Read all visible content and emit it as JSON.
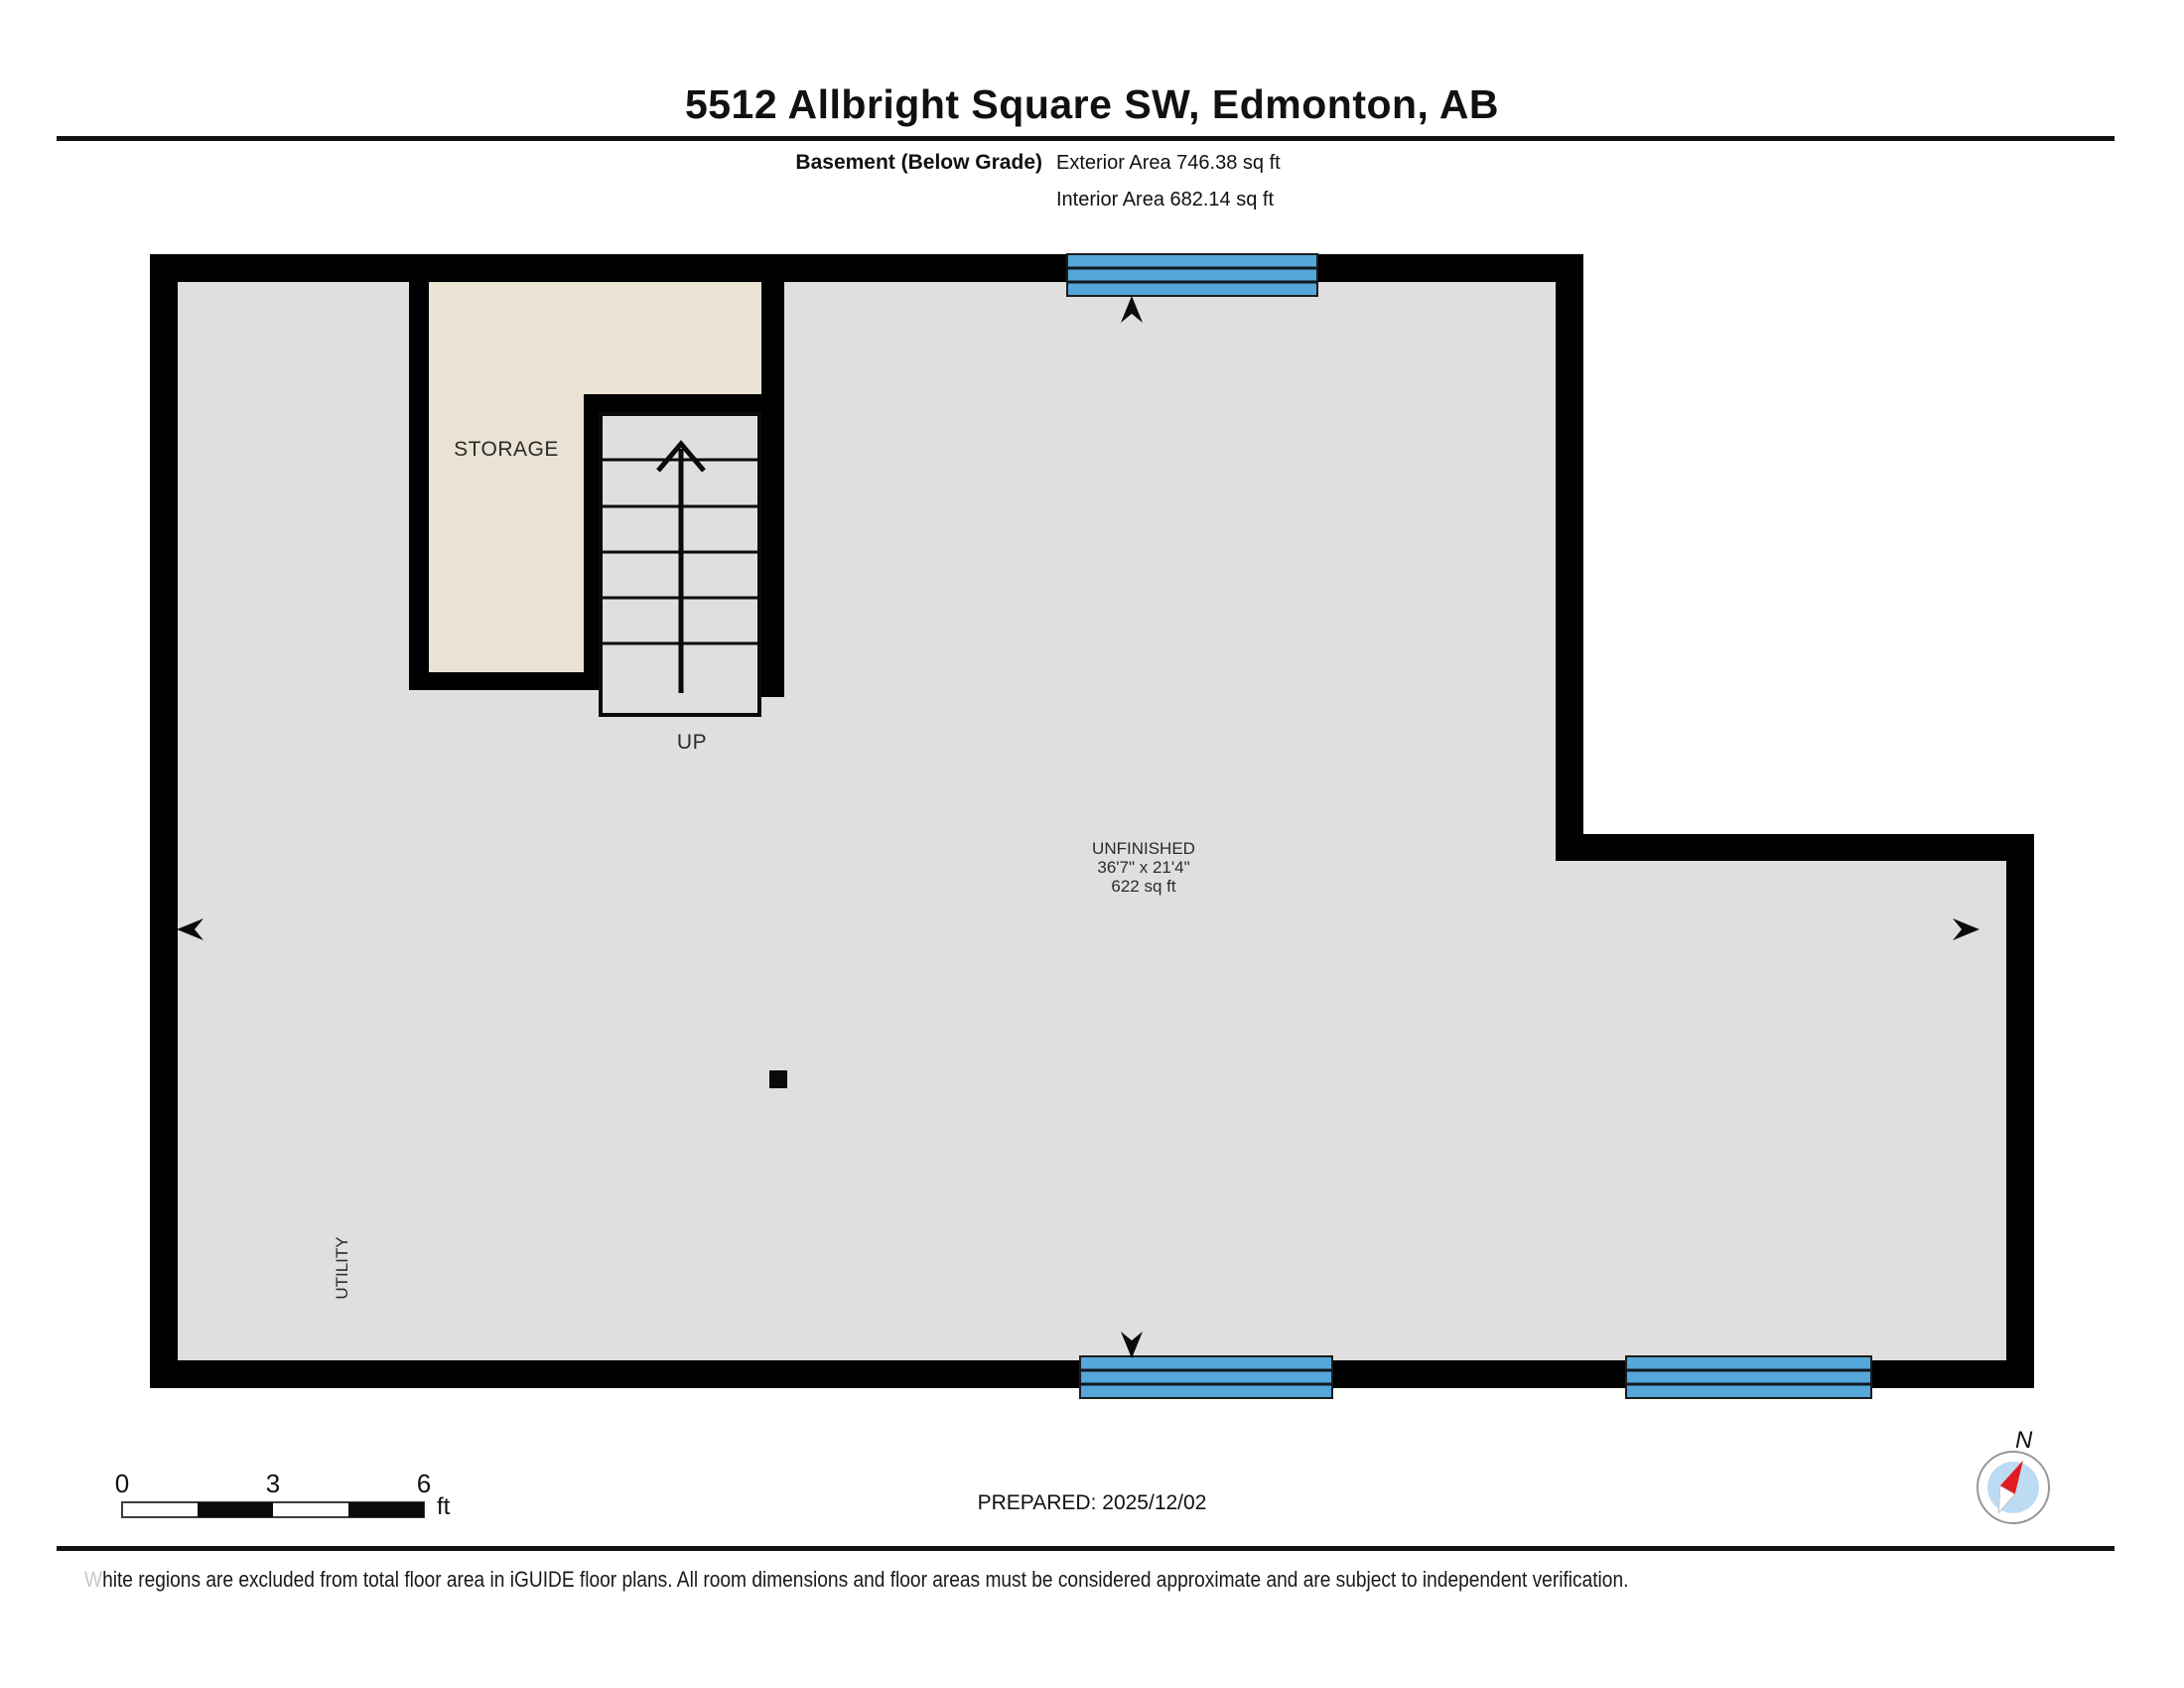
{
  "header": {
    "title": "5512 Allbright Square SW, Edmonton, AB"
  },
  "subtitle": {
    "floor_label": "Basement (Below Grade)",
    "exterior_area": "Exterior Area 746.38 sq ft",
    "interior_area": "Interior Area 682.14 sq ft"
  },
  "plan": {
    "rooms": {
      "storage_label": "STORAGE",
      "stairs_label": "UP",
      "unfinished_name": "UNFINISHED",
      "unfinished_dimensions": "36'7\" x 21'4\"",
      "unfinished_area": "622 sq ft",
      "utility_label": "UTILITY"
    },
    "colors": {
      "wall": "#000000",
      "floor": "#dfdfdf",
      "storage": "#eae2d3",
      "window": "#55a6d9",
      "compass_inner": "#bcdcf4",
      "compass_needle": "#e11b22"
    }
  },
  "footer": {
    "scale": {
      "tick0": "0",
      "tick3": "3",
      "tick6": "6",
      "unit": "ft"
    },
    "prepared": "PREPARED: 2025/12/02",
    "compass_label": "N",
    "disclaimer_first_letter": "W",
    "disclaimer_rest": "hite regions are excluded from total floor area in iGUIDE floor plans. All room dimensions and floor areas must be considered approximate and are subject to independent verification."
  }
}
